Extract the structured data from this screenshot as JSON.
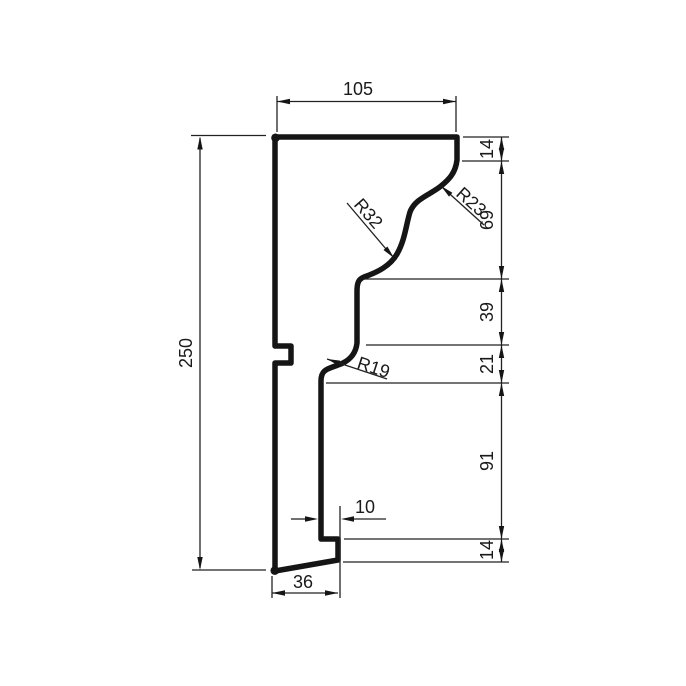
{
  "drawing": {
    "colors": {
      "line": "#151515",
      "background": "#ffffff"
    },
    "labels": {
      "top_width": "105",
      "total_height": "250",
      "chain": [
        "14",
        "69",
        "39",
        "21",
        "91",
        "14"
      ],
      "bottom_width": "36",
      "step_width": "10",
      "radius_upper": "R23",
      "radius_ogee": "R32",
      "radius_lower": "R19"
    }
  }
}
